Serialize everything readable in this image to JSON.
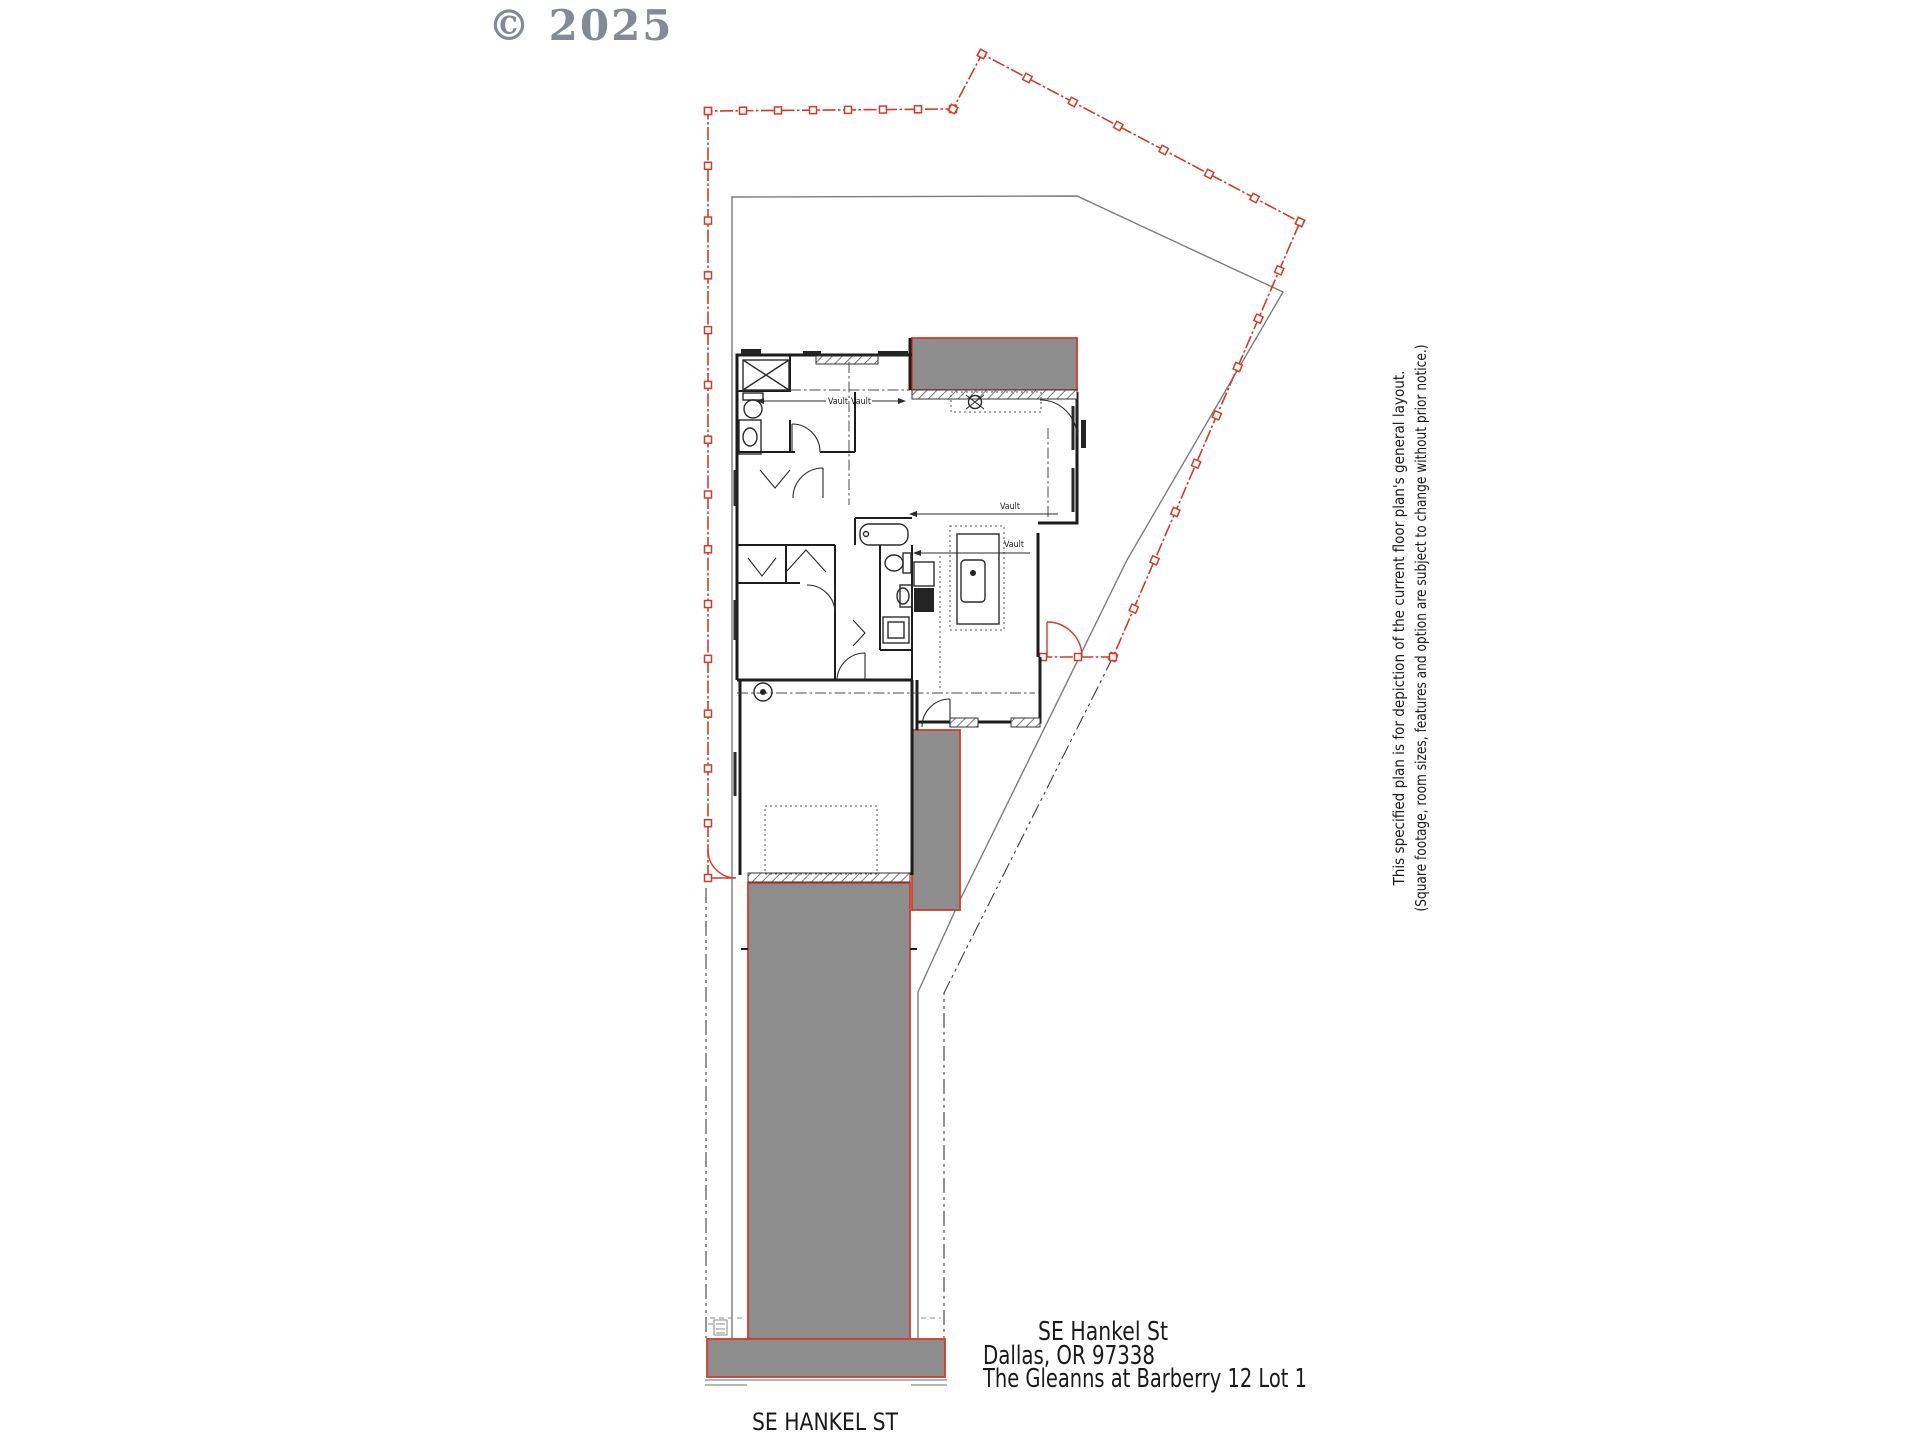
{
  "watermark": "© 2025",
  "colors": {
    "boundary_red": "#d23b2a",
    "area_gray": "#8d8d8d",
    "wall_black": "#1c1c1c",
    "setback_gray": "#7c7c7c",
    "watermark_gray": "#7a818b"
  },
  "labels": {
    "vault": "Vault"
  },
  "address": {
    "line1": "SE Hankel St",
    "line2": "Dallas, OR 97338",
    "line3": "The Gleanns at Barberry 12 Lot 1"
  },
  "street_label": "SE HANKEL ST",
  "disclaimer": {
    "line1": "This specified plan is for depiction of the current floor plan's general layout.",
    "line2": "(Square footage, room sizes, features and option are subject to change without prior notice.)"
  }
}
